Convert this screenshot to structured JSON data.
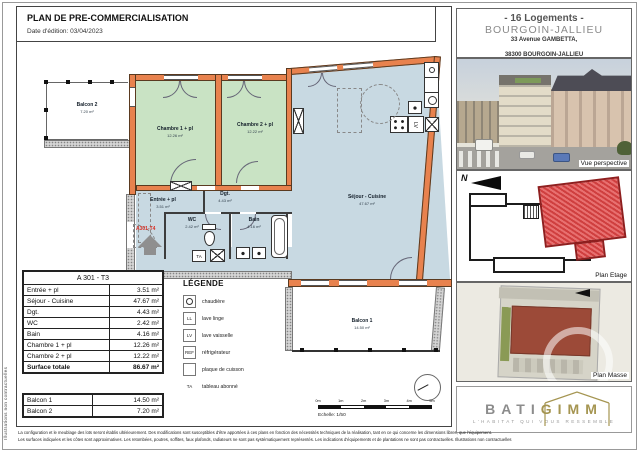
{
  "colors": {
    "wall-orange": "#E8824E",
    "room-green": "#C9E3C4",
    "room-blue": "#C8D9E2",
    "unit-red": "#D84A44",
    "masse-brown": "#9C4A38",
    "logo-gray": "#8C8C8C",
    "logo-gold": "#A59551",
    "ref-red": "#D93025"
  },
  "header": {
    "title": "PLAN DE PRE-COMMERCIALISATION",
    "date": "Date d'édition: 03/04/2023"
  },
  "project": {
    "units": "- 16 Logements -",
    "city": "BOURGOIN-JALLIEU",
    "address_line1": "33 Avenue GAMBETTA,",
    "address_line2": "38300 BOURGOIN-JALLIEU"
  },
  "sidebar": {
    "perspective_label": "Vue perspective",
    "floor_plan_label": "Plan Etage",
    "mass_plan_label": "Plan Masse",
    "north_letter": "N"
  },
  "logo": {
    "name_part1": "BATI",
    "name_part2": "GIMM",
    "tagline": "L'HABITAT QUI VOUS RESSEMBLE"
  },
  "rooms": {
    "balcon2": {
      "name": "Balcon 2",
      "area": "7.20 m²"
    },
    "chambre1": {
      "name": "Chambre 1 + pl",
      "area": "12.26 m²"
    },
    "chambre2": {
      "name": "Chambre 2 + pl",
      "area": "12.22 m²"
    },
    "sejour": {
      "name": "Séjour - Cuisine",
      "area": "47.67 m²"
    },
    "entree": {
      "name": "Entrée + pl",
      "area": "3.51 m²"
    },
    "dgt": {
      "name": "Dgt.",
      "area": "4.43 m²"
    },
    "wc": {
      "name": "WC",
      "area": "2.42 m²"
    },
    "bain": {
      "name": "Bain",
      "area": "4.16 m²"
    },
    "balcon1": {
      "name": "Balcon 1",
      "area": "14.50 m²"
    }
  },
  "fixtures": {
    "lv": "LV",
    "ta": "TA"
  },
  "plan": {
    "unit_ref": "A301-T4",
    "scale_label": "Echelle: 1/50",
    "scale_ticks": [
      "0m",
      "1m",
      "2m",
      "3m",
      "4m",
      "5m"
    ]
  },
  "tables": {
    "unit": {
      "title": "A 301 - T3",
      "rows": [
        {
          "label": "Entrée + pl",
          "value": "3.51 m²"
        },
        {
          "label": "Séjour - Cuisine",
          "value": "47.67 m²"
        },
        {
          "label": "Dgt.",
          "value": "4.43 m²"
        },
        {
          "label": "WC",
          "value": "2.42 m²"
        },
        {
          "label": "Bain",
          "value": "4.16 m²"
        },
        {
          "label": "Chambre 1 + pl",
          "value": "12.26 m²"
        },
        {
          "label": "Chambre 2 + pl",
          "value": "12.22 m²"
        },
        {
          "label": "Surface totale",
          "value": "86.67 m²"
        }
      ]
    },
    "balconies": {
      "rows": [
        {
          "label": "Balcon 1",
          "value": "14.50 m²"
        },
        {
          "label": "Balcon 2",
          "value": "7.20 m²"
        }
      ]
    }
  },
  "legend": {
    "title": "LÉGENDE",
    "items": [
      {
        "symbol": "circle-icon",
        "label": "chaudière"
      },
      {
        "symbol": "LL",
        "label": "lave linge"
      },
      {
        "symbol": "LV",
        "label": "lave vaisselle"
      },
      {
        "symbol": "REF",
        "label": "réfrigérateur"
      },
      {
        "symbol": "burner-icon",
        "label": "plaque de cuisson"
      },
      {
        "symbol": "TA",
        "label": "tableau abonné"
      }
    ]
  },
  "footer": {
    "line1": "La configuration et le meublage des lots seront établis ultérieurement. Des modifications sont susceptibles d'être apportées à ces plans en fonction des nécessités techniques de la réalisation, tant en ce qui concerne les dimensions libres, que l'équipement.",
    "line2": "Les surfaces indiquées et les côtes sont approximatives. Les retombées, poutres, soffites, faux plafonds, radiateurs ne sont pas systématiquement représentés. Les indications d'équipements et de plantations ne sont pas contractuelles. Illustrations non contractuelles",
    "side_note": "Illustrations non contractuelles"
  }
}
